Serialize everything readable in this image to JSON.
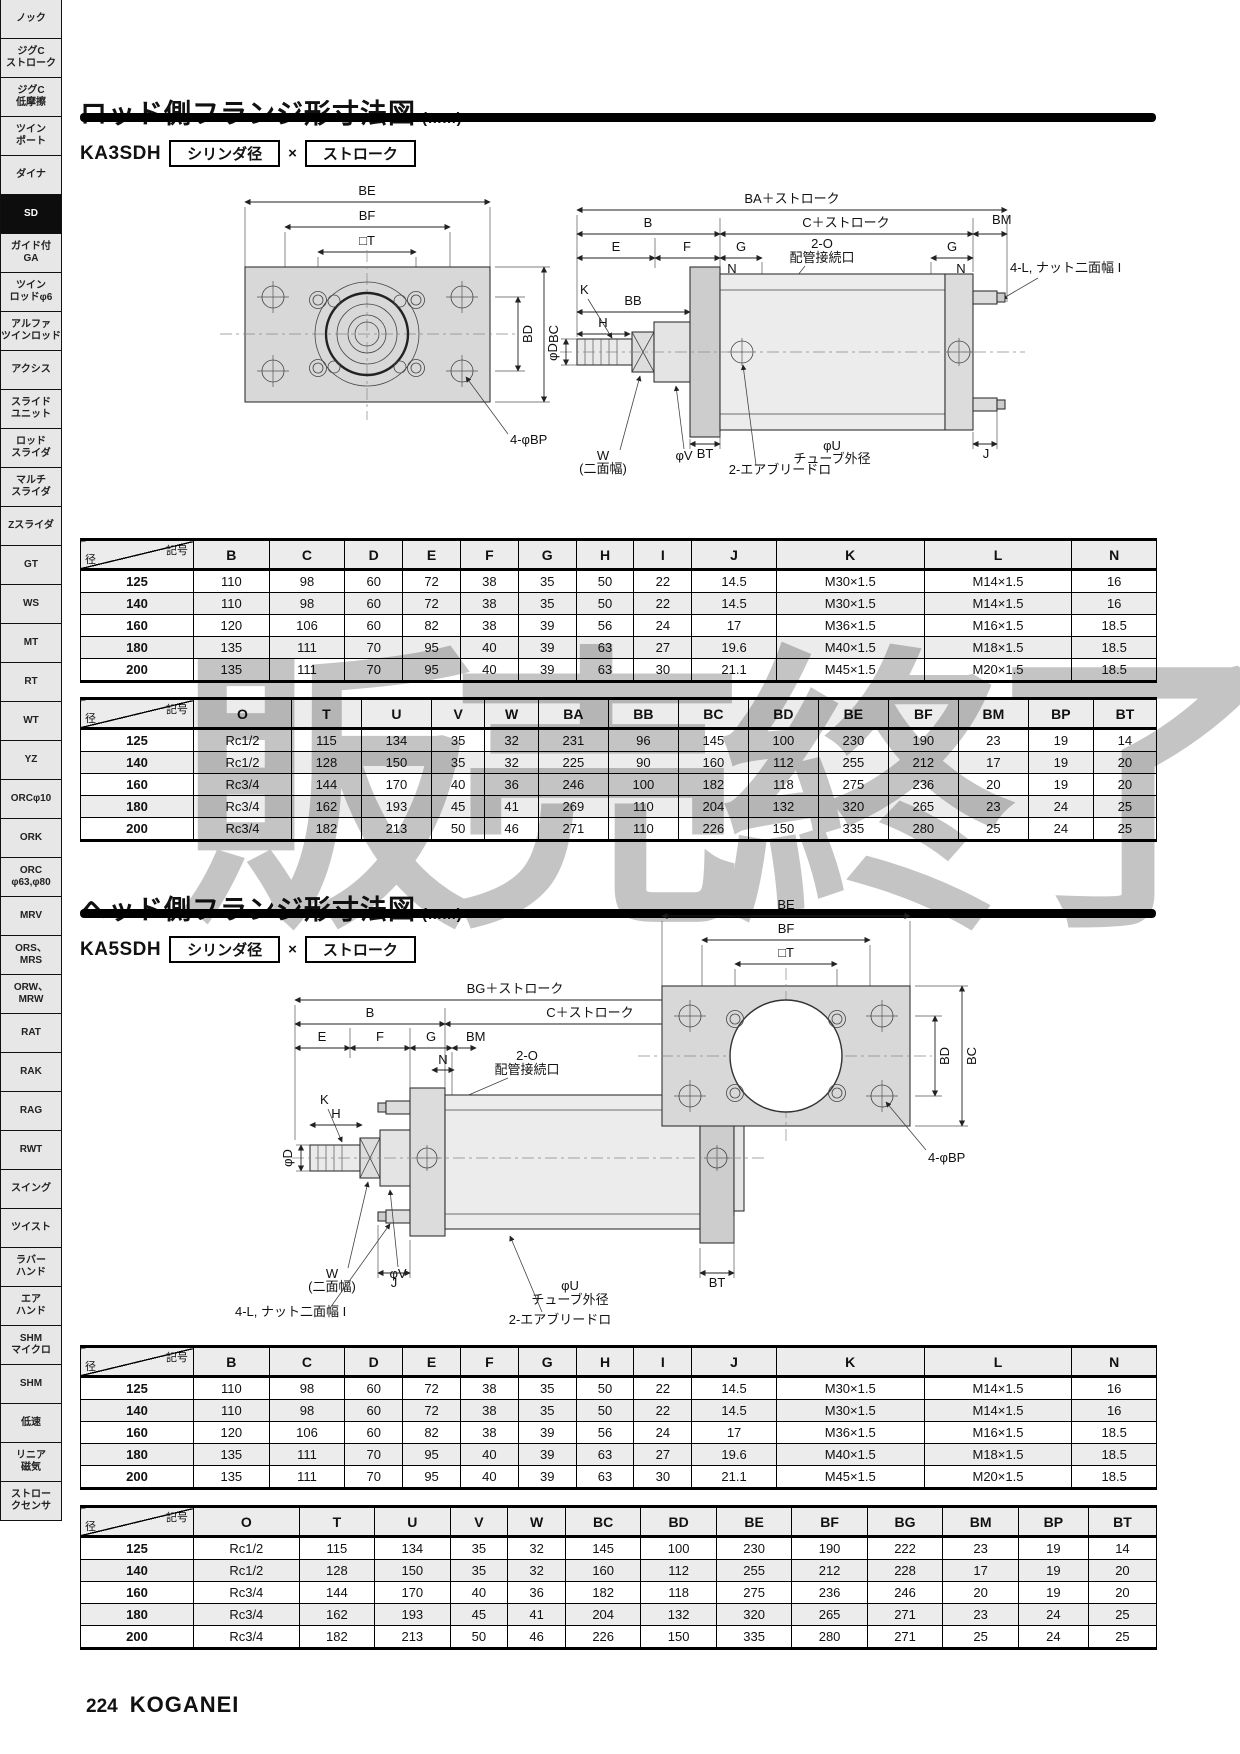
{
  "colors": {
    "bar": "#000000",
    "sidebar_active_bg": "#0d0d0d",
    "watermark_gray": "#8a8a8a",
    "drawing_fill": "#d8d8d8"
  },
  "watermark": "販売終了",
  "sidebar": {
    "items": [
      {
        "label": "ノック",
        "active": false
      },
      {
        "label": "ジグC\nストローク",
        "active": false
      },
      {
        "label": "ジグC\n低摩擦",
        "active": false
      },
      {
        "label": "ツイン\nポート",
        "active": false
      },
      {
        "label": "ダイナ",
        "active": false
      },
      {
        "label": "SD",
        "active": true
      },
      {
        "label": "ガイド付\nGA",
        "active": false
      },
      {
        "label": "ツイン\nロッドφ6",
        "active": false
      },
      {
        "label": "アルファ\nツインロッド",
        "active": false
      },
      {
        "label": "アクシス",
        "active": false
      },
      {
        "label": "スライド\nユニット",
        "active": false
      },
      {
        "label": "ロッド\nスライダ",
        "active": false
      },
      {
        "label": "マルチ\nスライダ",
        "active": false
      },
      {
        "label": "Zスライダ",
        "active": false
      },
      {
        "label": "GT",
        "active": false
      },
      {
        "label": "WS",
        "active": false
      },
      {
        "label": "MT",
        "active": false
      },
      {
        "label": "RT",
        "active": false
      },
      {
        "label": "WT",
        "active": false
      },
      {
        "label": "YZ",
        "active": false
      },
      {
        "label": "ORCφ10",
        "active": false
      },
      {
        "label": "ORK",
        "active": false
      },
      {
        "label": "ORC\nφ63,φ80",
        "active": false
      },
      {
        "label": "MRV",
        "active": false
      },
      {
        "label": "ORS、\nMRS",
        "active": false
      },
      {
        "label": "ORW、\nMRW",
        "active": false
      },
      {
        "label": "RAT",
        "active": false
      },
      {
        "label": "RAK",
        "active": false
      },
      {
        "label": "RAG",
        "active": false
      },
      {
        "label": "RWT",
        "active": false
      },
      {
        "label": "スイング",
        "active": false
      },
      {
        "label": "ツイスト",
        "active": false
      },
      {
        "label": "ラバー\nハンド",
        "active": false
      },
      {
        "label": "エア\nハンド",
        "active": false
      },
      {
        "label": "SHM\nマイクロ",
        "active": false
      },
      {
        "label": "SHM",
        "active": false
      },
      {
        "label": "低速",
        "active": false
      },
      {
        "label": "リニア\n磁気",
        "active": false
      },
      {
        "label": "ストロー\nクセンサ",
        "active": false
      }
    ]
  },
  "section1": {
    "title": "ロッド側フランジ形寸法図",
    "unit": "(mm)",
    "model": "KA3SDH",
    "box1": "シリンダ径",
    "times": "×",
    "box2": "ストローク"
  },
  "section2": {
    "title": "ヘッド側フランジ形寸法図",
    "unit": "(mm)",
    "model": "KA5SDH",
    "box1": "シリンダ径",
    "times": "×",
    "box2": "ストローク"
  },
  "drawing1": {
    "front": {
      "be": "BE",
      "bf": "BF",
      "t": "□T",
      "bd": "BD",
      "bc": "BC",
      "bp": "4-φBP"
    },
    "side": {
      "ba": "BA＋ストローク",
      "b": "B",
      "c": "C＋ストローク",
      "bm": "BM",
      "e": "E",
      "f": "F",
      "g1": "G",
      "g2": "G",
      "n1": "N",
      "n2": "N",
      "o": "2-O",
      "port": "配管接続口",
      "nut": "4-L, ナット二面幅 I",
      "k": "K",
      "bb": "BB",
      "h": "H",
      "d": "φD",
      "w": "W",
      "w2": "(二面幅)",
      "v": "φV",
      "bt": "BT",
      "u": "φU",
      "tube": "チューブ外径",
      "j": "J",
      "bleed": "2-エアブリードロ"
    }
  },
  "drawing2": {
    "side": {
      "bg": "BG＋ストローク",
      "b": "B",
      "c": "C＋ストローク",
      "e": "E",
      "f": "F",
      "g1": "G",
      "g2": "G",
      "bm": "BM",
      "n1": "N",
      "n2": "N",
      "o": "2-O",
      "port": "配管接続口",
      "k": "K",
      "h": "H",
      "d": "φD",
      "w": "W",
      "w2": "(二面幅)",
      "v": "φV",
      "nut": "4-L, ナット二面幅 I",
      "j": "J",
      "u": "φU",
      "tube": "チューブ外径",
      "bt": "BT",
      "bleed": "2-エアブリードロ"
    },
    "front": {
      "be": "BE",
      "bf": "BF",
      "t": "□T",
      "bd": "BD",
      "bc": "BC",
      "bp": "4-φBP"
    }
  },
  "tables": {
    "dim1": {
      "corner_top": "記号",
      "corner_bottom": "径",
      "columns": [
        "B",
        "C",
        "D",
        "E",
        "F",
        "G",
        "H",
        "I",
        "J",
        "K",
        "L",
        "N"
      ],
      "rows": [
        {
          "dia": "125",
          "cells": [
            "110",
            "98",
            "60",
            "72",
            "38",
            "35",
            "50",
            "22",
            "14.5",
            "M30×1.5",
            "M14×1.5",
            "16"
          ]
        },
        {
          "dia": "140",
          "cells": [
            "110",
            "98",
            "60",
            "72",
            "38",
            "35",
            "50",
            "22",
            "14.5",
            "M30×1.5",
            "M14×1.5",
            "16"
          ]
        },
        {
          "dia": "160",
          "cells": [
            "120",
            "106",
            "60",
            "82",
            "38",
            "39",
            "56",
            "24",
            "17",
            "M36×1.5",
            "M16×1.5",
            "18.5"
          ]
        },
        {
          "dia": "180",
          "cells": [
            "135",
            "111",
            "70",
            "95",
            "40",
            "39",
            "63",
            "27",
            "19.6",
            "M40×1.5",
            "M18×1.5",
            "18.5"
          ]
        },
        {
          "dia": "200",
          "cells": [
            "135",
            "111",
            "70",
            "95",
            "40",
            "39",
            "63",
            "30",
            "21.1",
            "M45×1.5",
            "M20×1.5",
            "18.5"
          ]
        }
      ]
    },
    "rod_mount": {
      "corner_top": "記号",
      "corner_bottom": "径",
      "columns": [
        "O",
        "T",
        "U",
        "V",
        "W",
        "BA",
        "BB",
        "BC",
        "BD",
        "BE",
        "BF",
        "BM",
        "BP",
        "BT"
      ],
      "rows": [
        {
          "dia": "125",
          "cells": [
            "Rc1/2",
            "115",
            "134",
            "35",
            "32",
            "231",
            "96",
            "145",
            "100",
            "230",
            "190",
            "23",
            "19",
            "14"
          ]
        },
        {
          "dia": "140",
          "cells": [
            "Rc1/2",
            "128",
            "150",
            "35",
            "32",
            "225",
            "90",
            "160",
            "112",
            "255",
            "212",
            "17",
            "19",
            "20"
          ]
        },
        {
          "dia": "160",
          "cells": [
            "Rc3/4",
            "144",
            "170",
            "40",
            "36",
            "246",
            "100",
            "182",
            "118",
            "275",
            "236",
            "20",
            "19",
            "20"
          ]
        },
        {
          "dia": "180",
          "cells": [
            "Rc3/4",
            "162",
            "193",
            "45",
            "41",
            "269",
            "110",
            "204",
            "132",
            "320",
            "265",
            "23",
            "24",
            "25"
          ]
        },
        {
          "dia": "200",
          "cells": [
            "Rc3/4",
            "182",
            "213",
            "50",
            "46",
            "271",
            "110",
            "226",
            "150",
            "335",
            "280",
            "25",
            "24",
            "25"
          ]
        }
      ]
    },
    "head_mount": {
      "corner_top": "記号",
      "corner_bottom": "径",
      "columns": [
        "O",
        "T",
        "U",
        "V",
        "W",
        "BC",
        "BD",
        "BE",
        "BF",
        "BG",
        "BM",
        "BP",
        "BT"
      ],
      "rows": [
        {
          "dia": "125",
          "cells": [
            "Rc1/2",
            "115",
            "134",
            "35",
            "32",
            "145",
            "100",
            "230",
            "190",
            "222",
            "23",
            "19",
            "14"
          ]
        },
        {
          "dia": "140",
          "cells": [
            "Rc1/2",
            "128",
            "150",
            "35",
            "32",
            "160",
            "112",
            "255",
            "212",
            "228",
            "17",
            "19",
            "20"
          ]
        },
        {
          "dia": "160",
          "cells": [
            "Rc3/4",
            "144",
            "170",
            "40",
            "36",
            "182",
            "118",
            "275",
            "236",
            "246",
            "20",
            "19",
            "20"
          ]
        },
        {
          "dia": "180",
          "cells": [
            "Rc3/4",
            "162",
            "193",
            "45",
            "41",
            "204",
            "132",
            "320",
            "265",
            "271",
            "23",
            "24",
            "25"
          ]
        },
        {
          "dia": "200",
          "cells": [
            "Rc3/4",
            "182",
            "213",
            "50",
            "46",
            "226",
            "150",
            "335",
            "280",
            "271",
            "25",
            "24",
            "25"
          ]
        }
      ]
    }
  },
  "footer": {
    "page": "224",
    "brand": "KOGANEI"
  }
}
